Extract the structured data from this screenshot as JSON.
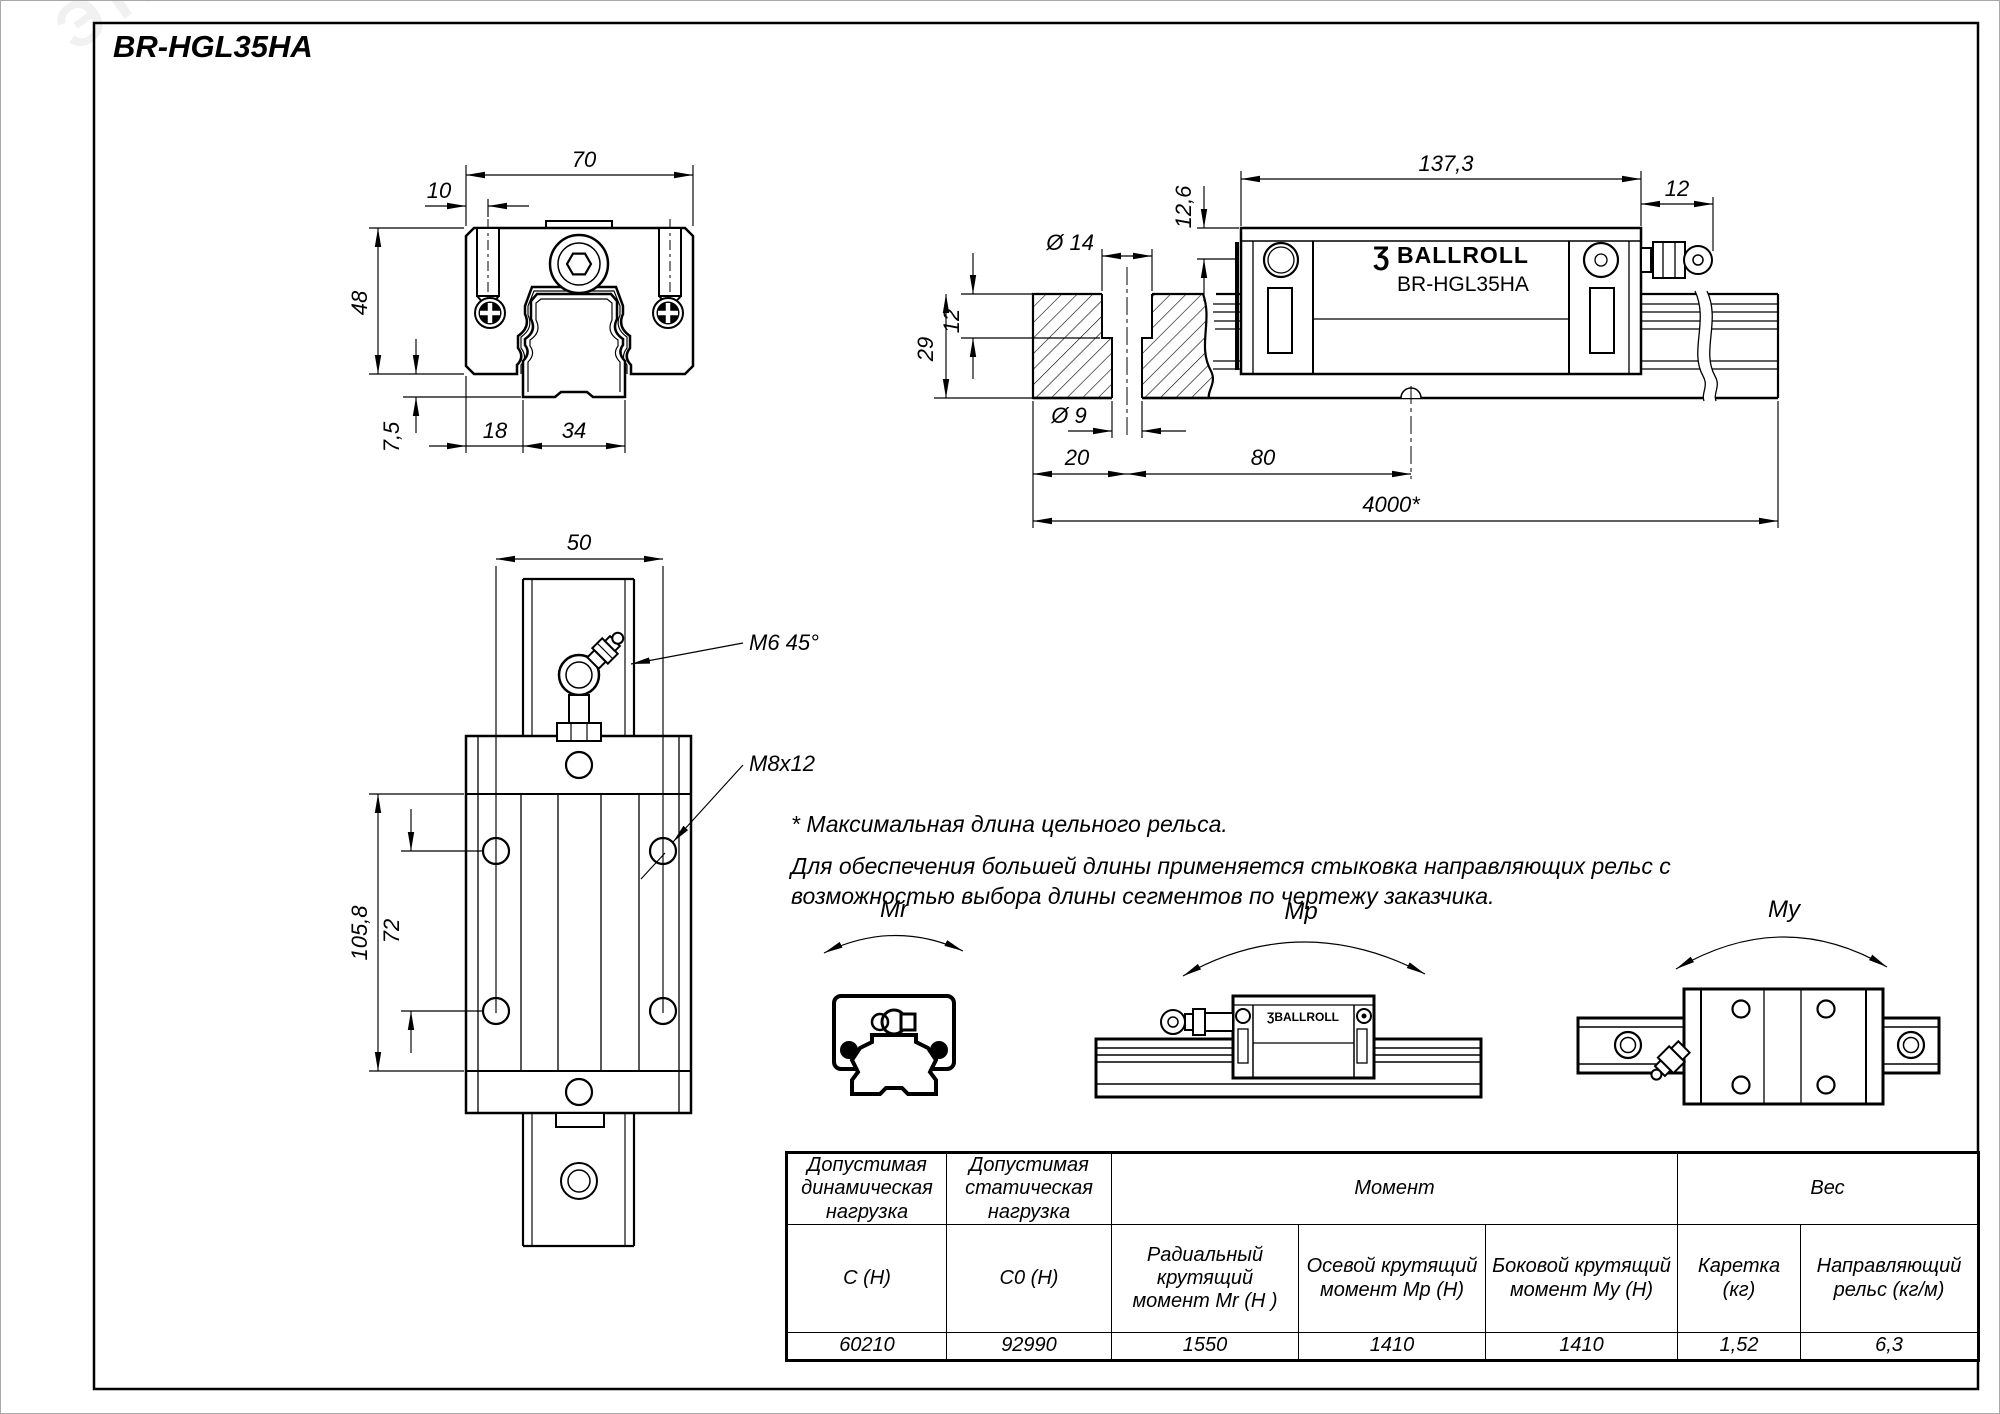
{
  "page": {
    "title": "BR-HGL35HA",
    "watermark": "ЭТМ"
  },
  "front_view": {
    "dim_width_top": "70",
    "dim_slot_offset": "10",
    "dim_height": "48",
    "dim_rail_clearance": "7,5",
    "dim_base_left": "18",
    "dim_rail_width": "34"
  },
  "side_view": {
    "dim_length": "137,3",
    "dim_top_offset": "12,6",
    "dim_nipple_len": "12",
    "dim_counterbore_dia": "Ø 14",
    "dim_counterbore_depth": "12",
    "dim_rail_height": "29",
    "dim_hole_dia": "Ø 9",
    "dim_end_to_hole": "20",
    "dim_hole_pitch": "80",
    "dim_max_length": "4000*",
    "brand_mark": "Ʒ",
    "brand": "BALLROLL",
    "model": "BR-HGL35HA"
  },
  "plan_view": {
    "dim_rail_width": "50",
    "label_grease_thread": "M6 45°",
    "label_mount_thread": "M8x12",
    "dim_body_length": "105,8",
    "dim_hole_spacing": "72"
  },
  "notes": {
    "note_asterisk": "* Максимальная длина цельного рельса.",
    "note_joining": "Для обеспечения большей длины применяется стыковка направляющих рельс с возможностью выбора длины сегментов по чертежу заказчика."
  },
  "moments": {
    "mr": "Mr",
    "mp": "Mp",
    "my": "My",
    "brand_small": "ƷBALLROLL"
  },
  "table": {
    "header_dynamic": "Допустимая динамическая нагрузка",
    "header_static": "Допустимая статическая нагрузка",
    "header_moment": "Момент",
    "header_weight": "Вес",
    "sub_dynamic": "C (Н)",
    "sub_static": "C0 (Н)",
    "sub_mr": "Радиальный крутящий момент Mr (Н )",
    "sub_mp": "Осевой крутящий момент Мр (Н)",
    "sub_my": "Боковой крутящий момент Му (Н)",
    "sub_carriage": "Каретка (кг)",
    "sub_rail": "Направляющий рельс (кг/м)",
    "val_dynamic": "60210",
    "val_static": "92990",
    "val_mr": "1550",
    "val_mp": "1410",
    "val_my": "1410",
    "val_carriage": "1,52",
    "val_rail": "6,3"
  }
}
